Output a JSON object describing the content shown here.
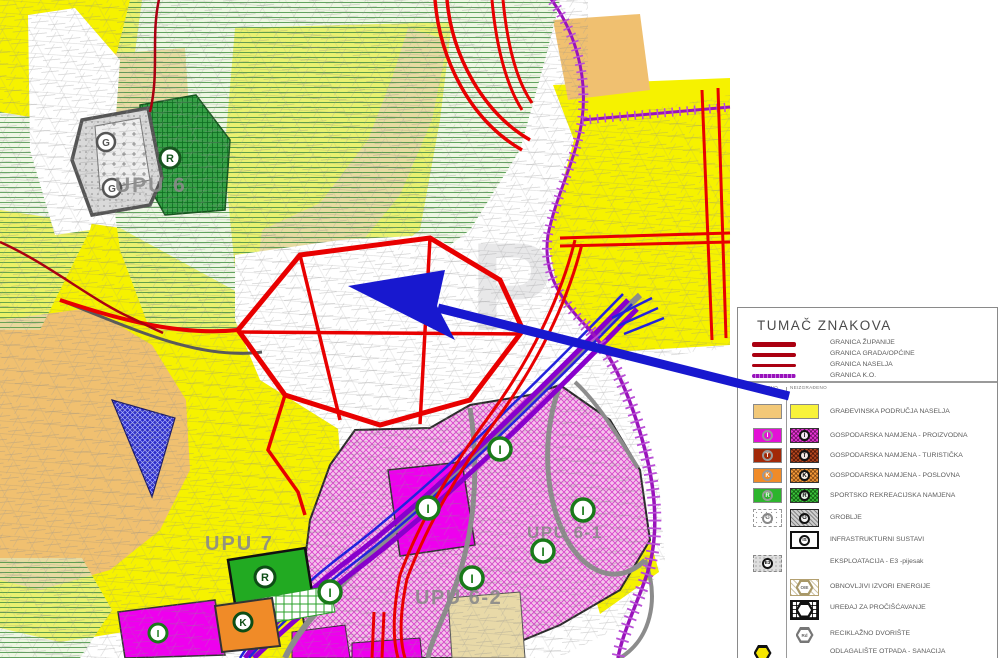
{
  "legend": {
    "title": "TUMAČ ZNAKOVA",
    "column_headers": {
      "built": "IZGRAĐENO",
      "unbuilt": "NEIZGRAĐENO"
    },
    "boundaries": [
      {
        "label": "GRANICA ŽUPANIJE"
      },
      {
        "label": "GRANICA GRADA/OPĆINE"
      },
      {
        "label": "GRANICA NASELJA"
      },
      {
        "label": "GRANICA K.O."
      }
    ],
    "rows": [
      {
        "label": "GRAĐEVINSKA PODRUČJA NASELJA",
        "symbol": ""
      },
      {
        "label": "GOSPODARSKA NAMJENA - PROIZVODNA",
        "symbol": "I"
      },
      {
        "label": "GOSPODARSKA NAMJENA - TURISTIČKA",
        "symbol": "T"
      },
      {
        "label": "GOSPODARSKA NAMJENA - POSLOVNA",
        "symbol": "K"
      },
      {
        "label": "SPORTSKO REKREACIJSKA NAMJENA",
        "symbol": "R"
      },
      {
        "label": "GROBLJE",
        "symbol": "G"
      },
      {
        "label": "INFRASTRUKTURNI SUSTAVI",
        "symbol": "IS"
      },
      {
        "label": "EKSPLOATACIJA - E3 -pijesak",
        "symbol": "E3"
      },
      {
        "label": "OBNOVLJIVI IZVORI ENERGIJE",
        "symbol": "OIE"
      },
      {
        "label": "UREĐAJ ZA PROČIŠĆAVANJE",
        "symbol": ""
      },
      {
        "label": "RECIKLAŽNO DVORIŠTE",
        "symbol": "Rd"
      },
      {
        "label": "ODLAGALIŠTE OTPADA - SANACIJA",
        "symbol": ""
      }
    ]
  },
  "map": {
    "labels": {
      "upu6": "UPU 6",
      "upu7": "UPU 7",
      "upu62": "UPU 6-2",
      "upu61": "UPU 6-1"
    },
    "markers": {
      "proizvodna": "I",
      "sportsko": "R",
      "groblje": "G",
      "poslovna": "K"
    },
    "watermark": "P"
  },
  "colors": {
    "boundary_red": "#aa0011",
    "boundary_purple": "#9913bb",
    "road_red": "#e80000",
    "road_gray": "#8c8c8c",
    "arrow_blue": "#1818cf",
    "zone_yellow": "#f6f200",
    "zone_tan": "#f0c070",
    "zone_magenta": "#e600e6",
    "zone_green": "#2db52d"
  }
}
